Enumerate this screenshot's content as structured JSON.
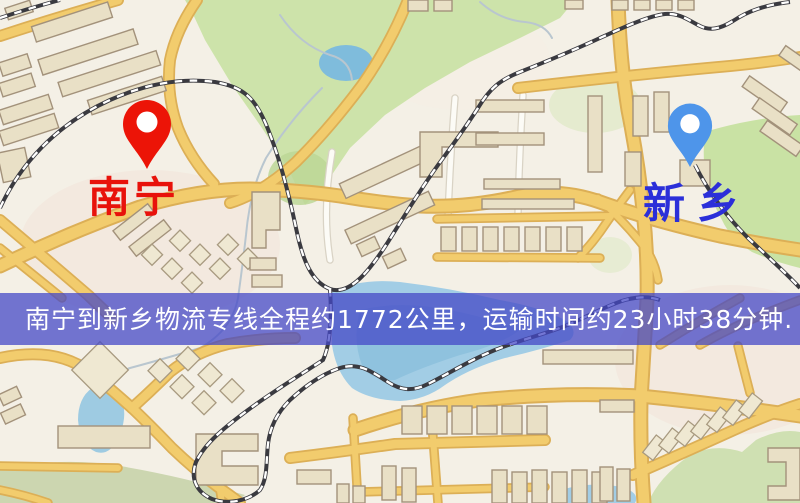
{
  "banner": {
    "text": "南宁到新乡物流专线全程约1772公里，运输时间约23小时38分钟.",
    "background_color": "#4347c6",
    "text_color": "#ffffff"
  },
  "markers": [
    {
      "id": "nanning",
      "label": "南宁",
      "pin_color": "#ec1407",
      "pin_inner_color": "#ffffff",
      "label_color": "#e8120b"
    },
    {
      "id": "xinxiang",
      "label": "新乡",
      "pin_color": "#4e95ea",
      "pin_inner_color": "#ffffff",
      "label_color": "#2b2fd9"
    }
  ],
  "map_palette": {
    "background": "#f4f0e6",
    "road_fill": "#f2cc6d",
    "road_casing": "#dcaf56",
    "park_green": "#cde3aa",
    "water_blue": "#a2cde5",
    "building_fill": "#e9e0c6",
    "railway_dark": "#3a3a40"
  }
}
